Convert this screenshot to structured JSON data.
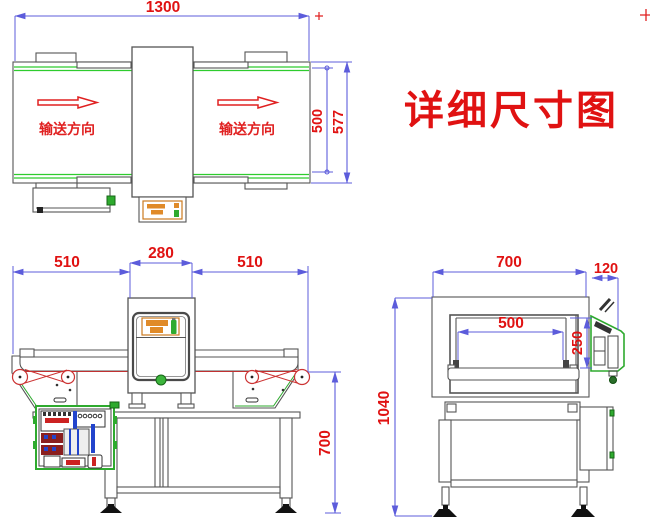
{
  "title": "详细尺寸图",
  "colors": {
    "dimension_blue": "#5c5cdb",
    "annotation_red": "#e01212",
    "machine_gray": "#555555",
    "belt_green": "#2ecc2e",
    "panel_orange": "#e08a28"
  },
  "top_view": {
    "dims": {
      "overall_length": "1300",
      "belt_width": "500",
      "frame_width": "577"
    },
    "flow_label_left": "输送方向",
    "flow_label_right": "输送方向"
  },
  "front_view": {
    "dims": {
      "left_conveyor": "510",
      "detector_width": "280",
      "right_conveyor": "510",
      "belt_height": "700"
    }
  },
  "side_view": {
    "dims": {
      "depth": "700",
      "panel_depth": "120",
      "tunnel_width": "500",
      "tunnel_height": "250",
      "total_height": "1040"
    }
  }
}
